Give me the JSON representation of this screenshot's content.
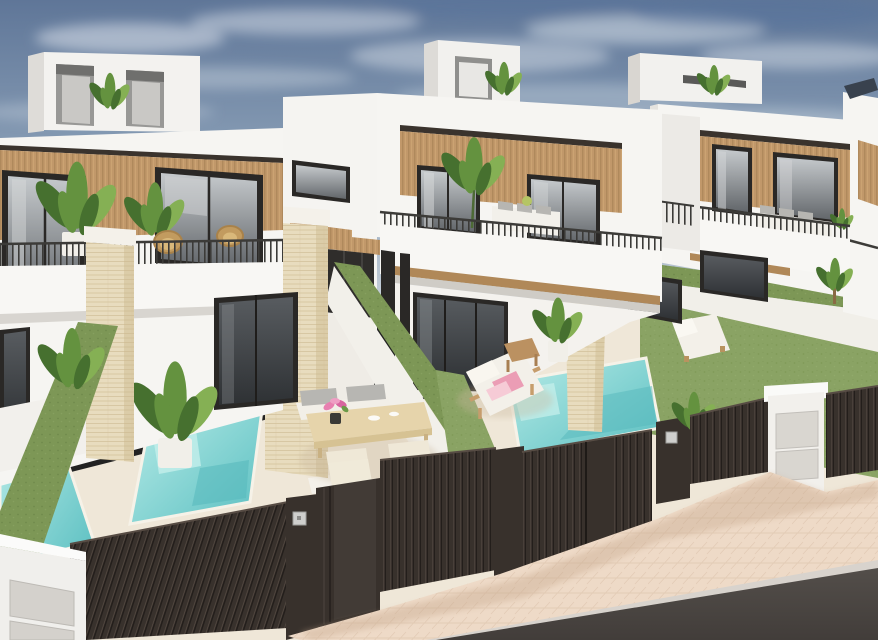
{
  "scene": {
    "kind": "exterior-3d-architectural-render",
    "subject": "Row of modern white two-storey townhouses with wood-slat cladding, private turquoise plunge pools, artificial-grass hedge walls, dark slatted street gates, beige sidewalk and asphalt road",
    "visible_text": "",
    "houses_visible": 4,
    "pools_visible": 3,
    "gates_visible": 3,
    "furniture": [
      "outdoor-dining-table-with-chairs",
      "sun-lounger-with-pink-towels",
      "lawn-lounger",
      "balcony-sofas",
      "wicker-chairs",
      "side-table"
    ],
    "vegetation": [
      "rooftop-plants",
      "balcony-strelitzia",
      "palm",
      "potted-plants",
      "small-tree"
    ],
    "street_items": [
      "utility-cabinet",
      "mailbox-pillar",
      "intercom-plates"
    ]
  },
  "colors": {
    "sky_top": "#5f7698",
    "sky_mid": "#8ca1b8",
    "sky_horizon": "#cdd5dd",
    "cloud": "#e9eef3",
    "wall_lit": "#f6f5f2",
    "wall_shade": "#e9e7e2",
    "wall_dark": "#d9d6d1",
    "wood": "#c1986a",
    "wood_dark": "#9f7a4e",
    "wood_trim": "#3a332d",
    "frame": "#2a2826",
    "glass_hi": "#c6cacd",
    "glass_lo": "#62666a",
    "railing": "#3c3b38",
    "travertine": "#e8dcbe",
    "travertine_line": "#d5c4a0",
    "travertine_cap": "#f4f1ea",
    "hedge": "#7d9756",
    "lawn": "#8aa364",
    "lawn_dark": "#7b9452",
    "pool_hi": "#b7ebe7",
    "pool_mid": "#86d4d3",
    "pool_lo": "#5fc1c3",
    "coping": "#f6f2e8",
    "ground": "#efe7d8",
    "fence": "#38312c",
    "fence_hi": "#574c44",
    "fence_gap": "#231e1b",
    "plate_silver": "#cfcfcd",
    "sidewalk": "#eedac7",
    "sidewalk_line": "#e0c8b2",
    "road": "#4e4945",
    "road_dark": "#423d3a",
    "curb": "#d8d3cd",
    "table_wood": "#e6d4ab",
    "cushion_gray": "#b7b6b2",
    "cushion_white": "#f3f0e9",
    "towel_pink": "#eb9db5",
    "towel_pink_light": "#f6cbd6",
    "flower_pink": "#e87fb0",
    "lounger_wood": "#c69d6c",
    "plant_dark": "#46702f",
    "plant_mid": "#64923f",
    "plant_light": "#85b054",
    "plant_yellow": "#b5c565",
    "pot_white": "#f1efe9",
    "mail_panel": "#d9d6d0",
    "solar_panel": "#39424e"
  }
}
